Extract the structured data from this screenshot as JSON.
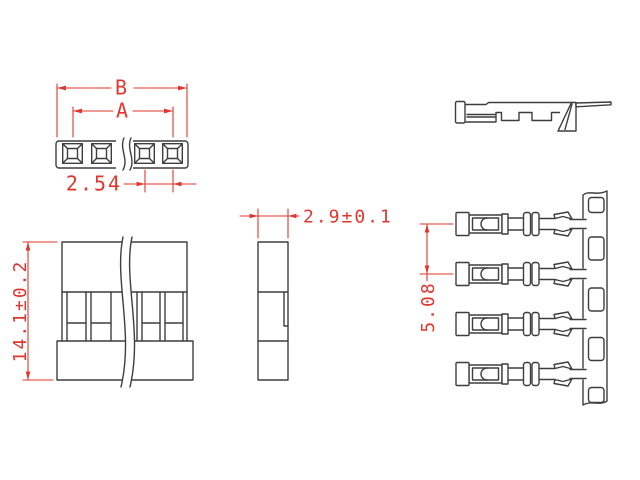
{
  "drawing": {
    "dims": {
      "overall_width_label": "B",
      "inner_width_label": "A",
      "hole_pitch": "2.54",
      "housing_height": "14.1±0.2",
      "housing_thickness": "2.9±0.1",
      "terminal_pitch": "5.08"
    },
    "colors": {
      "line": "#3e3e3e",
      "dimension": "#e0362e",
      "background": "#ffffff"
    }
  }
}
